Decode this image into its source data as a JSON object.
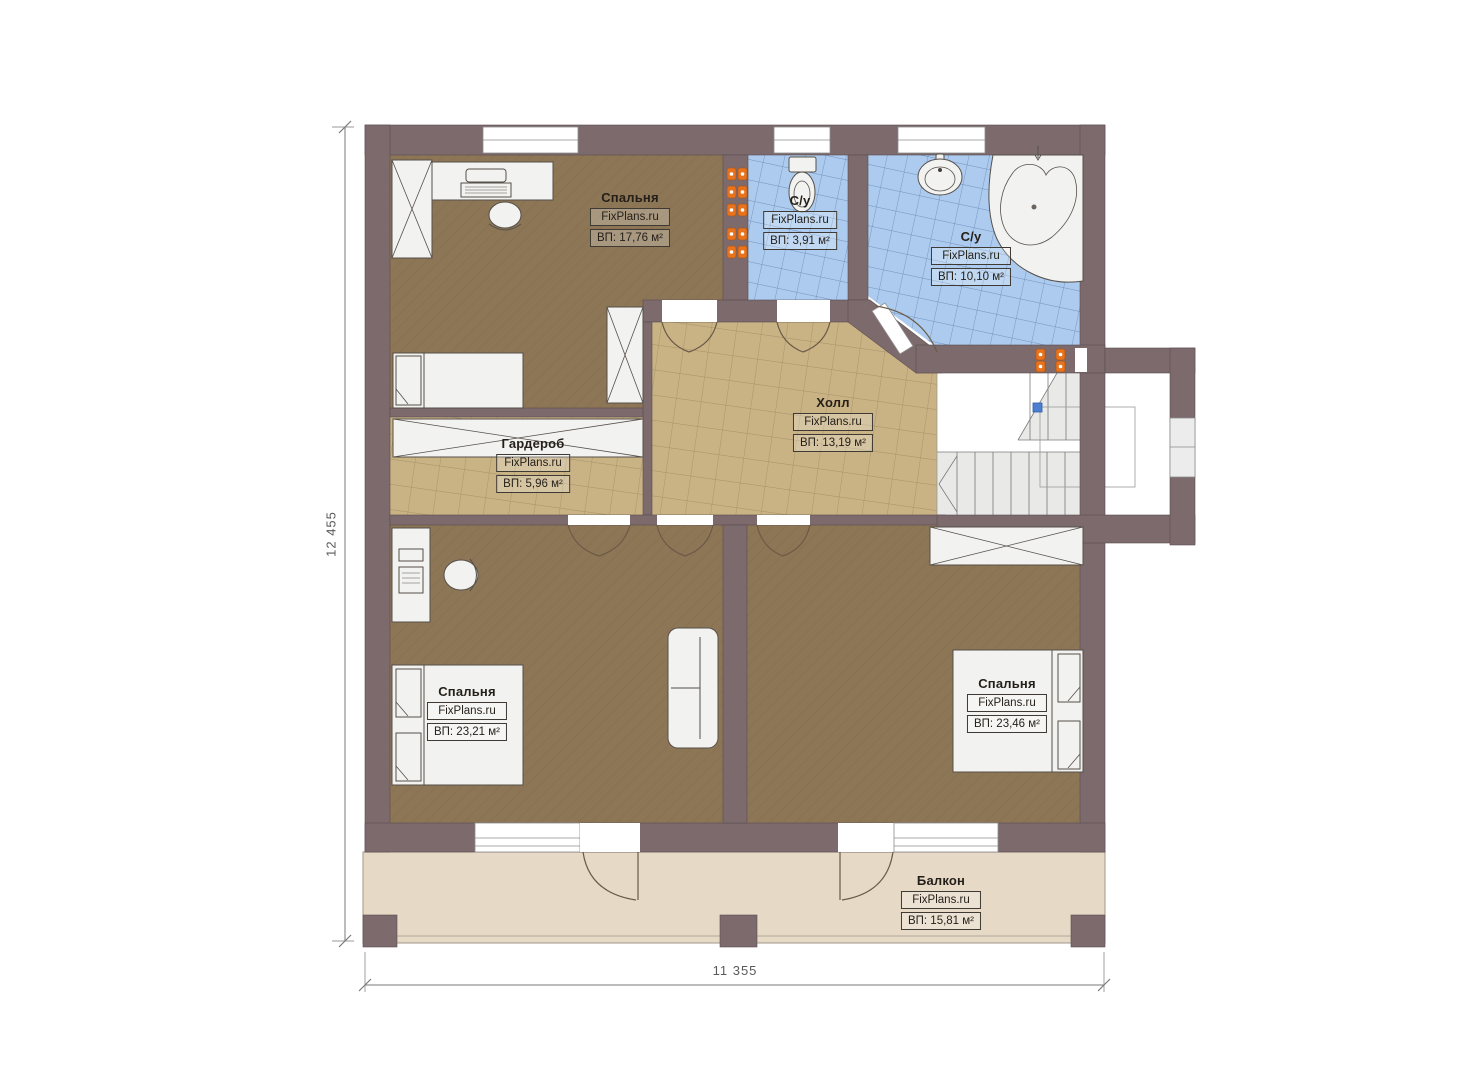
{
  "plan": {
    "rooms": [
      {
        "id": "bedroom-top",
        "name": "Спальня",
        "brand": "FixPlans.ru",
        "area": "ВП: 17,76 м²"
      },
      {
        "id": "bath-small",
        "name": "С/у",
        "brand": "FixPlans.ru",
        "area": "ВП: 3,91 м²"
      },
      {
        "id": "bath-large",
        "name": "С/у",
        "brand": "FixPlans.ru",
        "area": "ВП: 10,10 м²"
      },
      {
        "id": "hall",
        "name": "Холл",
        "brand": "FixPlans.ru",
        "area": "ВП: 13,19 м²"
      },
      {
        "id": "wardrobe",
        "name": "Гардероб",
        "brand": "FixPlans.ru",
        "area": "ВП: 5,96 м²"
      },
      {
        "id": "bedroom-left",
        "name": "Спальня",
        "brand": "FixPlans.ru",
        "area": "ВП: 23,21 м²"
      },
      {
        "id": "bedroom-right",
        "name": "Спальня",
        "brand": "FixPlans.ru",
        "area": "ВП: 23,46 м²"
      },
      {
        "id": "balcony",
        "name": "Балкон",
        "brand": "FixPlans.ru",
        "area": "ВП: 15,81 м²"
      }
    ],
    "dimensions": {
      "height_label": "12 455",
      "width_label": "11 355"
    },
    "colors": {
      "wall": "#7c6a6d",
      "bedroom_floor": "#8d7656",
      "tile_floor": "#c9b284",
      "bath_floor": "#accbee",
      "balcony_floor": "#e6d9c6",
      "stair_floor": "#ffffff",
      "radiator": "#e8731e",
      "stair_node": "#4d7fd0"
    }
  }
}
